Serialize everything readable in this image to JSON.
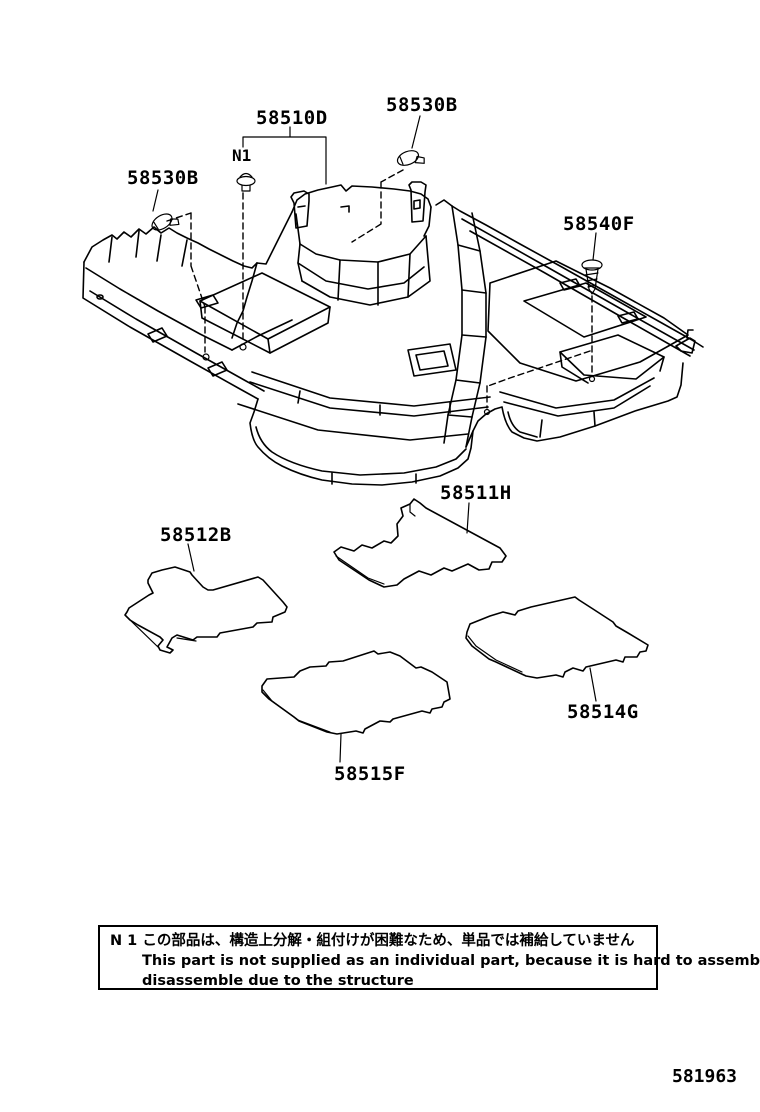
{
  "figure_code": "581963",
  "labels": {
    "l58530b_top": "58530B",
    "l58510d": "58510D",
    "n1": "N1",
    "l58530b_left": "58530B",
    "l58540f": "58540F",
    "l58511h": "58511H",
    "l58512b": "58512B",
    "l58514g": "58514G",
    "l58515f": "58515F"
  },
  "note": {
    "line1_ja": "N 1 この部品は、構造上分解・組付けが困難なため、単品では補給していません",
    "line2_en": "This part is not supplied as an individual part, because it is hard to assemble /",
    "line3_en": "disassemble due to the structure"
  },
  "icons": {
    "clip": "trim-clip-glyph",
    "pin": "push-pin-glyph",
    "screw": "tapping-screw-glyph"
  },
  "colors": {
    "line": "#000000",
    "background": "#ffffff"
  }
}
